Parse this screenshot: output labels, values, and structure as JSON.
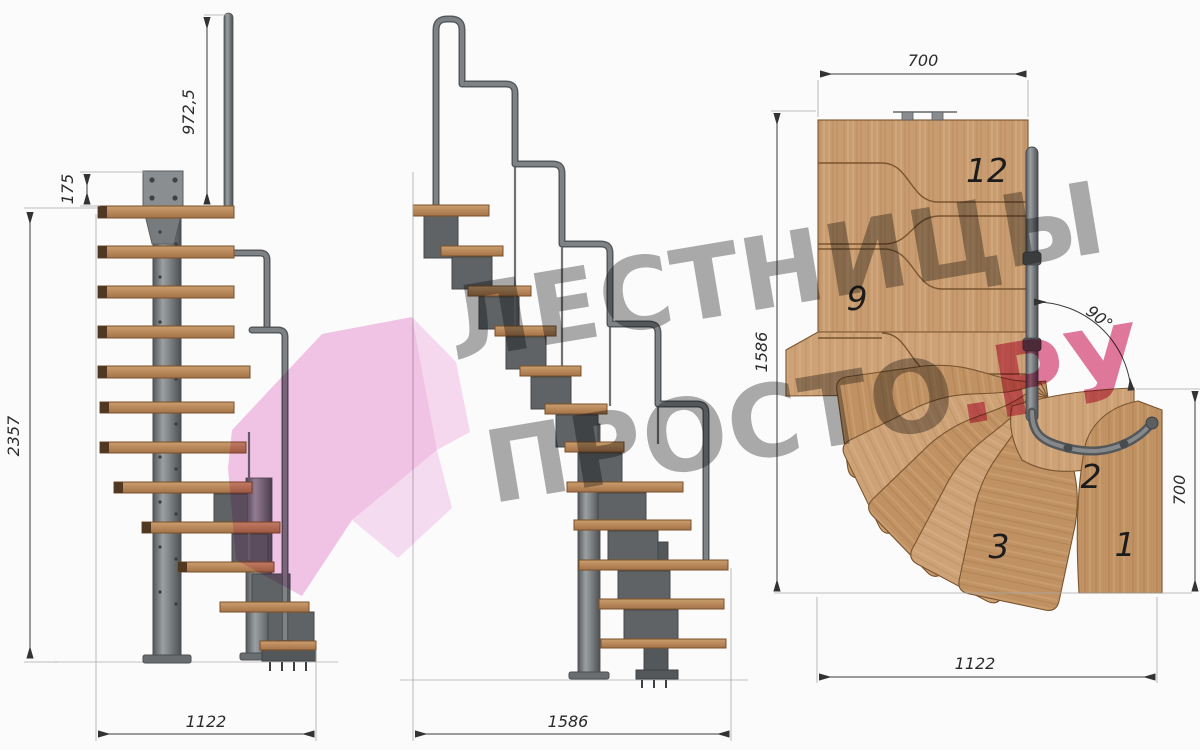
{
  "watermark": {
    "line1": "ЛЕСТНИЦЫ",
    "line2": "ПРОСТО",
    "line2_accent": ".РУ",
    "gray": "#707070",
    "pink": "#d63a6e",
    "arrow_pink": "#e98cd2"
  },
  "front_view": {
    "dim_rail_height": "972,5",
    "dim_step_rise": "175",
    "dim_total_height": "2357",
    "dim_width": "1122"
  },
  "side_view": {
    "dim_length": "1586"
  },
  "plan_view": {
    "dim_top_width": "700",
    "dim_left_length": "1586",
    "dim_right_width": "700",
    "dim_bottom_length": "1122",
    "turn_angle": "90°",
    "step_numbers": {
      "s12": "12",
      "s9": "9",
      "s3": "3",
      "s2": "2",
      "s1": "1"
    }
  },
  "colors": {
    "background": "#fbfbfb",
    "wood": "#c89c70",
    "wood_front": "#b9885a",
    "metal": "#6f7376",
    "dim_text": "#2b2b2b"
  }
}
